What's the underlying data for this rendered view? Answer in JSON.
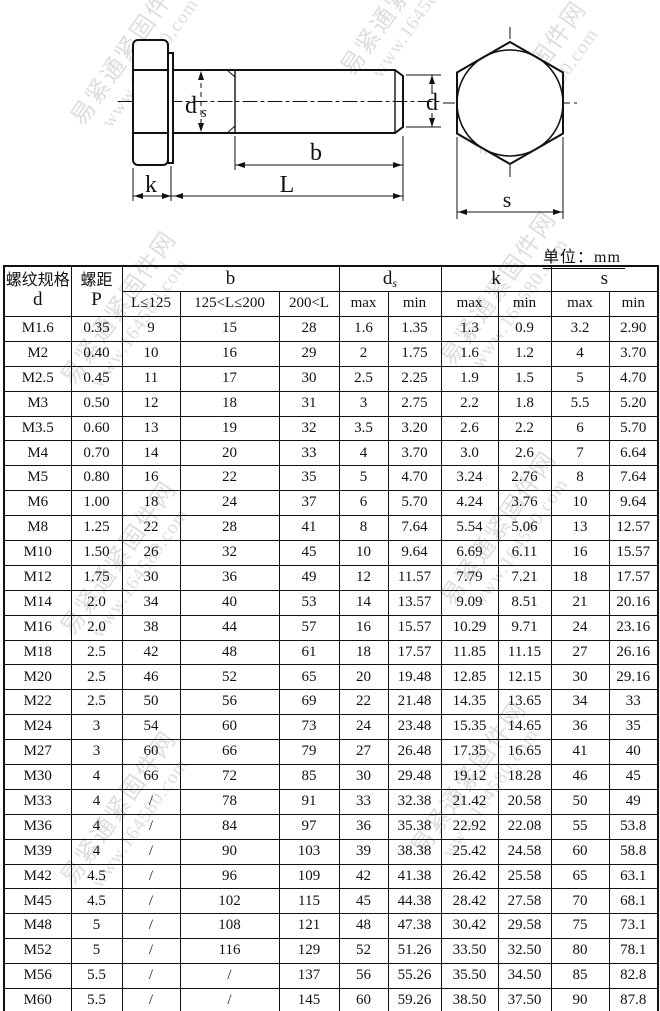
{
  "unit_label": "单位：mm",
  "diagram": {
    "labels": {
      "ds_main": "d",
      "ds_sub": "s",
      "d": "d",
      "b": "b",
      "length": "L",
      "k": "k",
      "s": "s"
    }
  },
  "table": {
    "col_keys": [
      "d",
      "P",
      "b_le125",
      "b_125_200",
      "b_gt200",
      "ds_max",
      "ds_min",
      "k_max",
      "k_min",
      "s_max",
      "s_min"
    ],
    "header": {
      "col1_line1": "螺纹规格",
      "col1_line2": "d",
      "col2_line1": "螺距",
      "col2_line2": "P",
      "b": "b",
      "ds_main": "d",
      "ds_sub": "s",
      "k": "k",
      "s": "s",
      "sub_row": [
        "L≤125",
        "125<L≤200",
        "200<L",
        "max",
        "min",
        "max",
        "min",
        "max",
        "min"
      ]
    },
    "rows": [
      [
        "M1.6",
        "0.35",
        "9",
        "15",
        "28",
        "1.6",
        "1.35",
        "1.3",
        "0.9",
        "3.2",
        "2.90"
      ],
      [
        "M2",
        "0.40",
        "10",
        "16",
        "29",
        "2",
        "1.75",
        "1.6",
        "1.2",
        "4",
        "3.70"
      ],
      [
        "M2.5",
        "0.45",
        "11",
        "17",
        "30",
        "2.5",
        "2.25",
        "1.9",
        "1.5",
        "5",
        "4.70"
      ],
      [
        "M3",
        "0.50",
        "12",
        "18",
        "31",
        "3",
        "2.75",
        "2.2",
        "1.8",
        "5.5",
        "5.20"
      ],
      [
        "M3.5",
        "0.60",
        "13",
        "19",
        "32",
        "3.5",
        "3.20",
        "2.6",
        "2.2",
        "6",
        "5.70"
      ],
      [
        "M4",
        "0.70",
        "14",
        "20",
        "33",
        "4",
        "3.70",
        "3.0",
        "2.6",
        "7",
        "6.64"
      ],
      [
        "M5",
        "0.80",
        "16",
        "22",
        "35",
        "5",
        "4.70",
        "3.24",
        "2.76",
        "8",
        "7.64"
      ],
      [
        "M6",
        "1.00",
        "18",
        "24",
        "37",
        "6",
        "5.70",
        "4.24",
        "3.76",
        "10",
        "9.64"
      ],
      [
        "M8",
        "1.25",
        "22",
        "28",
        "41",
        "8",
        "7.64",
        "5.54",
        "5.06",
        "13",
        "12.57"
      ],
      [
        "M10",
        "1.50",
        "26",
        "32",
        "45",
        "10",
        "9.64",
        "6.69",
        "6.11",
        "16",
        "15.57"
      ],
      [
        "M12",
        "1.75",
        "30",
        "36",
        "49",
        "12",
        "11.57",
        "7.79",
        "7.21",
        "18",
        "17.57"
      ],
      [
        "M14",
        "2.0",
        "34",
        "40",
        "53",
        "14",
        "13.57",
        "9.09",
        "8.51",
        "21",
        "20.16"
      ],
      [
        "M16",
        "2.0",
        "38",
        "44",
        "57",
        "16",
        "15.57",
        "10.29",
        "9.71",
        "24",
        "23.16"
      ],
      [
        "M18",
        "2.5",
        "42",
        "48",
        "61",
        "18",
        "17.57",
        "11.85",
        "11.15",
        "27",
        "26.16"
      ],
      [
        "M20",
        "2.5",
        "46",
        "52",
        "65",
        "20",
        "19.48",
        "12.85",
        "12.15",
        "30",
        "29.16"
      ],
      [
        "M22",
        "2.5",
        "50",
        "56",
        "69",
        "22",
        "21.48",
        "14.35",
        "13.65",
        "34",
        "33"
      ],
      [
        "M24",
        "3",
        "54",
        "60",
        "73",
        "24",
        "23.48",
        "15.35",
        "14.65",
        "36",
        "35"
      ],
      [
        "M27",
        "3",
        "60",
        "66",
        "79",
        "27",
        "26.48",
        "17.35",
        "16.65",
        "41",
        "40"
      ],
      [
        "M30",
        "4",
        "66",
        "72",
        "85",
        "30",
        "29.48",
        "19.12",
        "18.28",
        "46",
        "45"
      ],
      [
        "M33",
        "4",
        "/",
        "78",
        "91",
        "33",
        "32.38",
        "21.42",
        "20.58",
        "50",
        "49"
      ],
      [
        "M36",
        "4",
        "/",
        "84",
        "97",
        "36",
        "35.38",
        "22.92",
        "22.08",
        "55",
        "53.8"
      ],
      [
        "M39",
        "4",
        "/",
        "90",
        "103",
        "39",
        "38.38",
        "25.42",
        "24.58",
        "60",
        "58.8"
      ],
      [
        "M42",
        "4.5",
        "/",
        "96",
        "109",
        "42",
        "41.38",
        "26.42",
        "25.58",
        "65",
        "63.1"
      ],
      [
        "M45",
        "4.5",
        "/",
        "102",
        "115",
        "45",
        "44.38",
        "28.42",
        "27.58",
        "70",
        "68.1"
      ],
      [
        "M48",
        "5",
        "/",
        "108",
        "121",
        "48",
        "47.38",
        "30.42",
        "29.58",
        "75",
        "73.1"
      ],
      [
        "M52",
        "5",
        "/",
        "116",
        "129",
        "52",
        "51.26",
        "33.50",
        "32.50",
        "80",
        "78.1"
      ],
      [
        "M56",
        "5.5",
        "/",
        "/",
        "137",
        "56",
        "55.26",
        "35.50",
        "34.50",
        "85",
        "82.8"
      ],
      [
        "M60",
        "5.5",
        "/",
        "/",
        "145",
        "60",
        "59.26",
        "38.50",
        "37.50",
        "90",
        "87.8"
      ],
      [
        "M64",
        "6",
        "/",
        "/",
        "153",
        "64",
        "63.26",
        "40.50",
        "39.50",
        "95",
        "92.8"
      ]
    ]
  },
  "watermark": {
    "line1": "易紧通紧固件网",
    "line2": "www.164580.com"
  }
}
